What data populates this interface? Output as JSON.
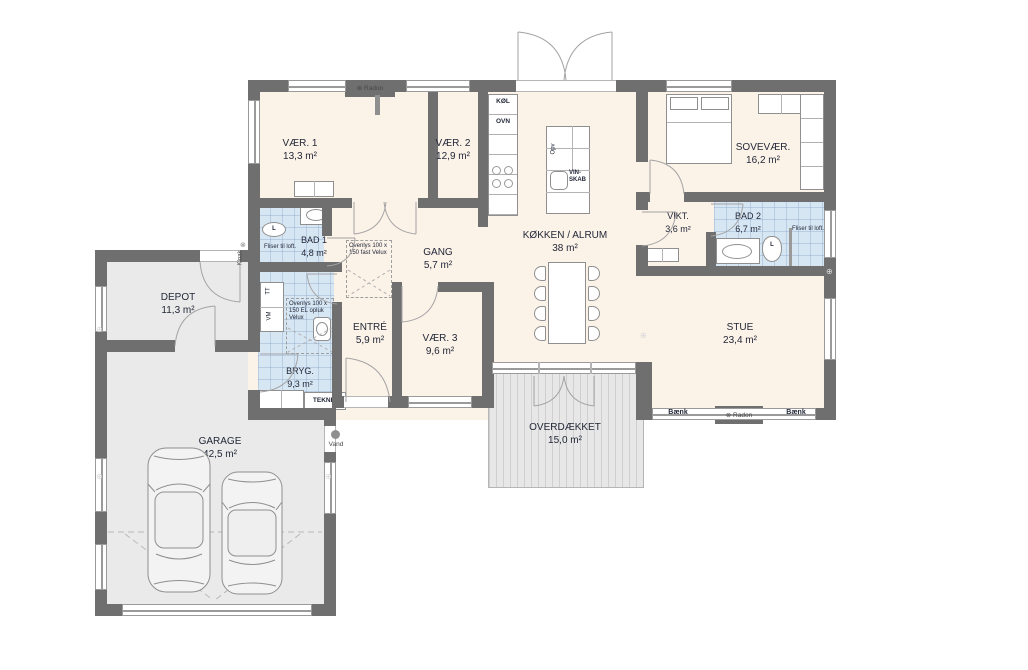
{
  "rooms": {
    "vaer1": {
      "name": "VÆR. 1",
      "area": "13,3 m²"
    },
    "vaer2": {
      "name": "VÆR. 2",
      "area": "12,9 m²"
    },
    "vaer3": {
      "name": "VÆR. 3",
      "area": "9,6 m²"
    },
    "sovevaer": {
      "name": "SOVEVÆR.",
      "area": "16,2 m²"
    },
    "bad1": {
      "name": "BAD 1",
      "area": "4,8 m²"
    },
    "bad2": {
      "name": "BAD 2",
      "area": "6,7 m²"
    },
    "gang": {
      "name": "GANG",
      "area": "5,7 m²"
    },
    "koekken_alrum": {
      "name": "KØKKEN / ALRUM",
      "area": "38 m²"
    },
    "vikt": {
      "name": "VIKT.",
      "area": "3,6 m²"
    },
    "depot": {
      "name": "DEPOT",
      "area": "11,3 m²"
    },
    "entre": {
      "name": "ENTRÉ",
      "area": "5,9 m²"
    },
    "stue": {
      "name": "STUE",
      "area": "23,4 m²"
    },
    "bryg": {
      "name": "BRYG.",
      "area": "9,3 m²"
    },
    "garage": {
      "name": "GARAGE",
      "area": "42,5 m²"
    },
    "overdaekket": {
      "name": "OVERDÆKKET",
      "area": "15,0 m²"
    }
  },
  "labels": {
    "koel": "KØL",
    "ovn": "OVN",
    "opv": "Opv",
    "vin_skab": "VIN-SKAB",
    "teknik": "TEKNIK",
    "tt": "TT",
    "vm": "VM",
    "baenk": "Bænk",
    "radon": "Radon",
    "radon_icon": "⊗",
    "kloak": "Kloak",
    "vand": "Vand",
    "fliser": "Fliser til loft.",
    "toilet": "L",
    "ovenlys_fast": "Ovenlys 100 x 150 fast Velux",
    "ovenlys_el": "Ovenlys 100 x 150 EL opluk Velux",
    "wall_symbol": "⊕"
  },
  "colors": {
    "wall": "#6F6F6F",
    "floor": "#FBF2E8",
    "bath": "#D7E6F3",
    "annex_floor": "#EAEAEA",
    "terrace": "#E4E4E4",
    "text": "#232838"
  }
}
